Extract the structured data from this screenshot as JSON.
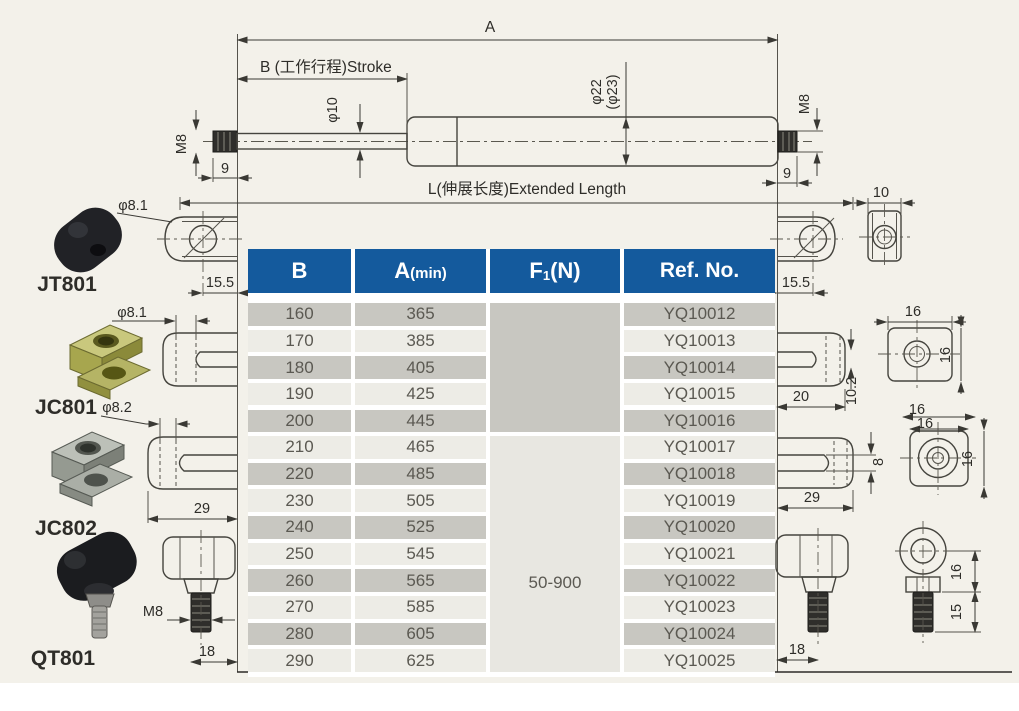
{
  "dims": {
    "a": "A",
    "b_stroke": "B (工作行程)Stroke",
    "phi10": "φ10",
    "phi22": "φ22",
    "phi23": "(φ23)",
    "m8": "M8",
    "nine": "9",
    "l": "L(伸展长度)Extended Length",
    "len155": "15.5",
    "w10": "10",
    "phi81": "φ8.1",
    "phi82": "φ8.2",
    "w20": "20",
    "s102": "10.2",
    "w29": "29",
    "s8": "8",
    "s16": "16",
    "s15": "15",
    "d18": "18"
  },
  "parts": {
    "jt801": "JT801",
    "jc801": "JC801",
    "jc802": "JC802",
    "qt801": "QT801"
  },
  "table": {
    "headers": {
      "b": "B",
      "a": "A",
      "a_sub": "(min)",
      "f": "F",
      "f_sub": "1",
      "f_rest": "(N)",
      "ref": "Ref. No."
    },
    "force_range": "50-900",
    "rows": [
      {
        "b": "160",
        "a": "365",
        "ref": "YQ10012"
      },
      {
        "b": "170",
        "a": "385",
        "ref": "YQ10013"
      },
      {
        "b": "180",
        "a": "405",
        "ref": "YQ10014"
      },
      {
        "b": "190",
        "a": "425",
        "ref": "YQ10015"
      },
      {
        "b": "200",
        "a": "445",
        "ref": "YQ10016"
      },
      {
        "b": "210",
        "a": "465",
        "ref": "YQ10017"
      },
      {
        "b": "220",
        "a": "485",
        "ref": "YQ10018"
      },
      {
        "b": "230",
        "a": "505",
        "ref": "YQ10019"
      },
      {
        "b": "240",
        "a": "525",
        "ref": "YQ10020"
      },
      {
        "b": "250",
        "a": "545",
        "ref": "YQ10021"
      },
      {
        "b": "260",
        "a": "565",
        "ref": "YQ10022"
      },
      {
        "b": "270",
        "a": "585",
        "ref": "YQ10023"
      },
      {
        "b": "280",
        "a": "605",
        "ref": "YQ10024"
      },
      {
        "b": "290",
        "a": "625",
        "ref": "YQ10025"
      }
    ]
  }
}
